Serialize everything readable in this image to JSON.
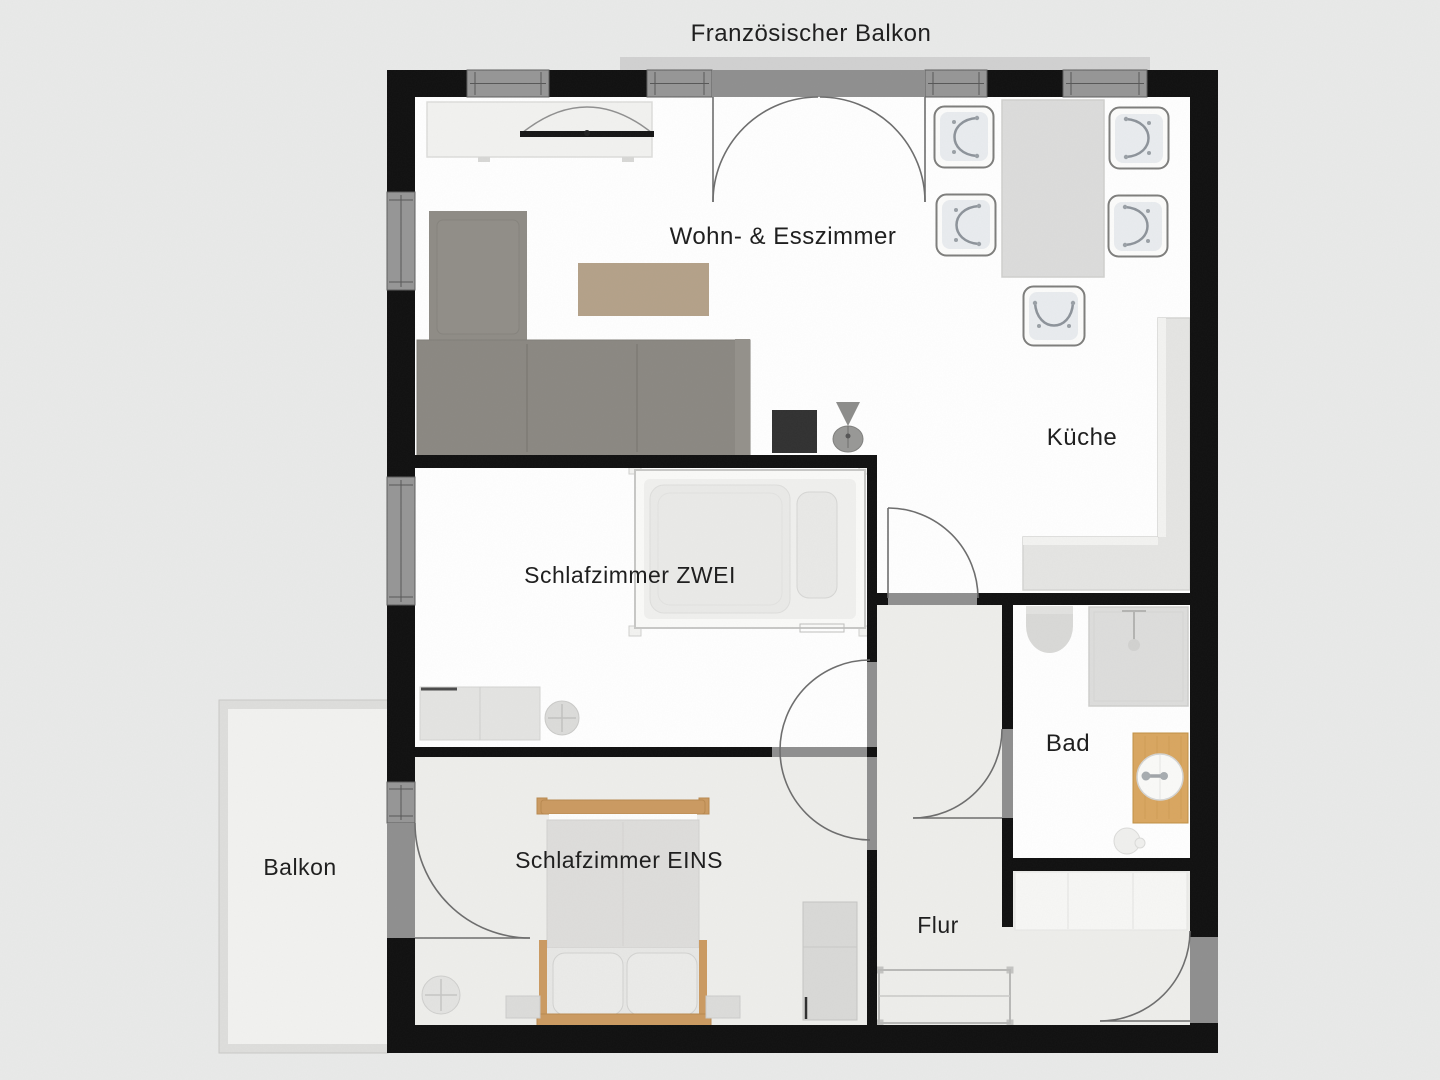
{
  "plan": {
    "kind": "apartment floor plan",
    "labels": {
      "french_balcony": "Französischer Balkon",
      "living_dining": "Wohn- & Esszimmer",
      "kitchen": "Küche",
      "bedroom_two": "Schlafzimmer ZWEI",
      "bathroom": "Bad",
      "bedroom_one": "Schlafzimmer EINS",
      "hallway": "Flur",
      "balcony": "Balkon"
    }
  },
  "colors": {
    "background": "#e9eae9",
    "wall": "#101010",
    "window": "#969696",
    "door-opening": "#8f8f8f",
    "floor": "#ffffff",
    "floor-tinted": "#eeeeeb",
    "balcony-fill": "#f2f2f0",
    "balcony-frame": "#dededc",
    "arc": "#6d6d6d",
    "sofa": "#8b8882",
    "sofa-chaise": "#8f8c86",
    "coffee-table": "#b4a189",
    "wood": "#cb9a61",
    "counter": "#e5e5e3",
    "furniture-light": "#ececea",
    "text": "#1f1f1f"
  }
}
